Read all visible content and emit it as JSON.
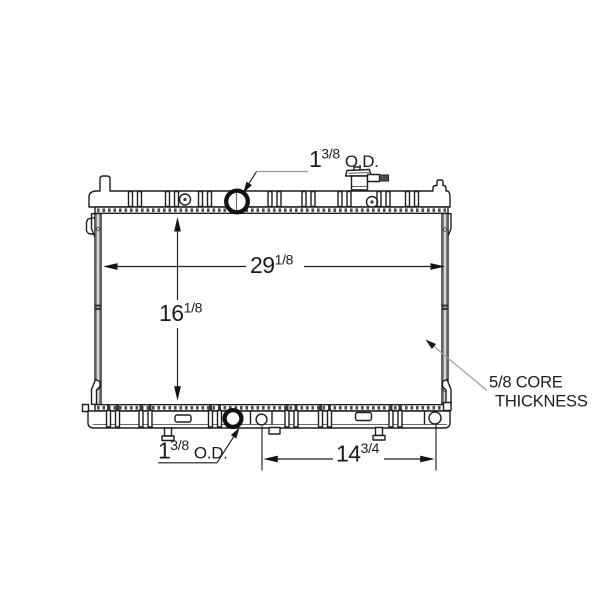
{
  "drawing": {
    "subject": "radiator-technical-diagram",
    "colors": {
      "background": "#ffffff",
      "line": "#1e1e1e",
      "leader": "#9b9b9b"
    }
  },
  "labels": {
    "top_port": {
      "whole": "1",
      "frac": "3/8",
      "suffix": "O.D."
    },
    "core_width": {
      "whole": "29",
      "frac": "1/8"
    },
    "core_height": {
      "whole": "16",
      "frac": "1/8"
    },
    "bottom_port": {
      "whole": "1",
      "frac": "3/8",
      "suffix": "O.D."
    },
    "lower_span": {
      "whole": "14",
      "frac": "3/4"
    },
    "core_thickness": {
      "line1": "5/8 CORE",
      "line2": "THICKNESS"
    }
  }
}
